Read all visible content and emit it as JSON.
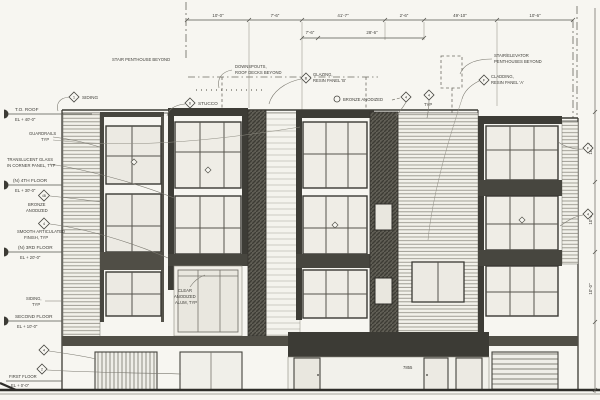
{
  "drawing": {
    "type": "architectural-elevation",
    "ink_color": "#45443f",
    "dark_panel_color": "#504e46",
    "awning_color": "#3c3b35",
    "paper_color": "#f7f6f1"
  },
  "levels": [
    {
      "name": "T.O. ROOF",
      "elev": "EL + 40'-0\""
    },
    {
      "name": "(N) 4TH FLOOR",
      "elev": "EL + 30'-0\""
    },
    {
      "name": "(N) 3RD FLOOR",
      "elev": "EL + 20'-0\""
    },
    {
      "name": "SECOND FLOOR",
      "elev": "EL + 10'-0\""
    },
    {
      "name": "FIRST FLOOR",
      "elev": "EL + 0'-0\""
    }
  ],
  "left_notes": {
    "guardrails": {
      "l1": "GUARDRAILS",
      "l2": "TYP"
    },
    "translucent": {
      "l1": "TRANSLUCENT GLASS",
      "l2": "IN CORNER PANEL, TYP"
    },
    "bronze": {
      "tag": "4B",
      "l1": "BRONZE",
      "l2": "ANODIZED"
    },
    "smooth": {
      "tag": "4",
      "l1": "SMOOTH ARTICULATED",
      "l2": "FINISH, TYP"
    },
    "siding_typ": {
      "l1": "SIDING,",
      "l2": "TYP"
    }
  },
  "bottom_tags": {
    "a": "4",
    "b": "2"
  },
  "top_notes": {
    "siding": {
      "tag": "1",
      "text": "SIDING"
    },
    "stair_penthouse": {
      "text": "STAIR PENTHOUSE BEYOND"
    },
    "downspouts": {
      "l1": "DOWNSPOUTS,",
      "l2": "ROOF DECKS BEYOND"
    },
    "stucco": {
      "tag": "6",
      "text": "STUCCO"
    },
    "glazing": {
      "tag": "B",
      "l1": "GLAZING,",
      "l2": "RESIN PANEL 'B'"
    },
    "bronze_anodized": {
      "text": "BRONZE ANODIZED"
    },
    "typ_tags": {
      "a": "4",
      "b": "4",
      "sub": "TYP"
    },
    "stair_elev": {
      "l1": "STAIR/ELEVATOR",
      "l2": "PENTHOUSES BEYOND"
    },
    "cladding": {
      "tag": "F",
      "l1": "CLADDING,",
      "l2": "RESIN PANEL 'A'"
    }
  },
  "mid_notes": {
    "clear_anodized": {
      "l1": "CLEAR",
      "l2": "ANODIZED",
      "l3": "ALUM, TYP"
    }
  },
  "edge_tags": {
    "right_upper": "F",
    "right_lower": "4"
  },
  "dims": {
    "top": [
      "10'-0\"",
      "7'-6\"",
      "41'-7\"",
      "2'-6\"",
      "49'-10\"",
      "10'-6\""
    ],
    "sub": [
      "7'-6\"",
      "28'-6\""
    ],
    "right": [
      "10'-0\"",
      "10'-0\"",
      "10'-0\""
    ]
  },
  "ground": {
    "address": "7855"
  }
}
